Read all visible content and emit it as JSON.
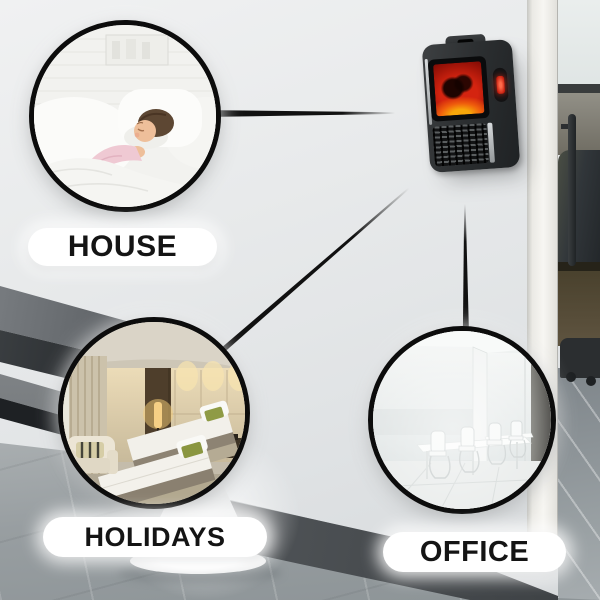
{
  "callouts": [
    {
      "id": "house",
      "label": "HOUSE"
    },
    {
      "id": "holidays",
      "label": "HOLIDAYS"
    },
    {
      "id": "office",
      "label": "OFFICE"
    }
  ],
  "product": {
    "type_icon": "flame-heater-icon"
  },
  "colors": {
    "circle_border": "#0c0c0c",
    "connector_line": "#111111",
    "label_background": "#ffffff",
    "label_text": "#141414",
    "flame_red": "#d42410",
    "flame_orange": "#f07c08",
    "led_red": "#e0301e"
  }
}
